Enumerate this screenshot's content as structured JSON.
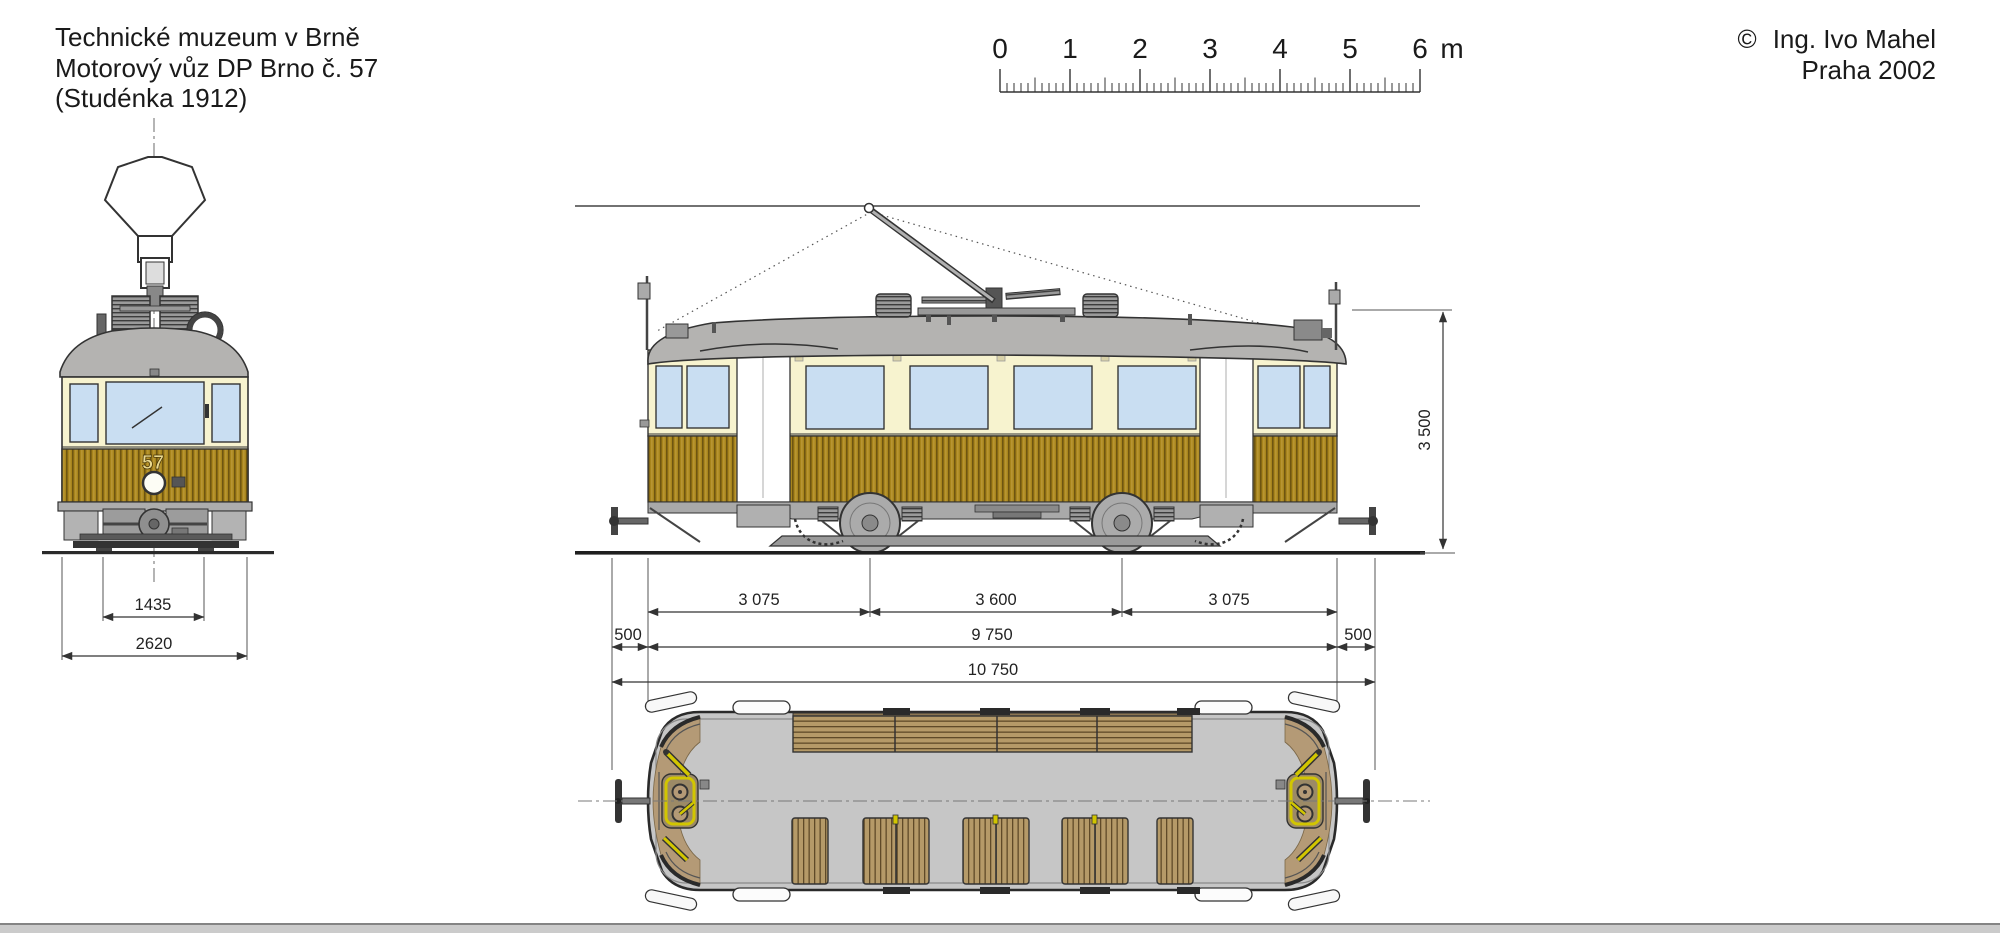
{
  "title_block": {
    "line1": "Technické muzeum v Brně",
    "line2": "Motorový vůz DP Brno č. 57",
    "line3": "(Studénka 1912)"
  },
  "credit": {
    "symbol": "©",
    "name": "Ing. Ivo Mahel",
    "city_year": "Praha 2002"
  },
  "scale_bar": {
    "tick_labels": [
      "0",
      "1",
      "2",
      "3",
      "4",
      "5",
      "6"
    ],
    "unit": "m",
    "minor_per_meter": 10
  },
  "vehicle": {
    "fleet_number": "57"
  },
  "dimensions": {
    "track_gauge_mm": "1435",
    "body_width_mm": "2620",
    "height_mm": "3 500",
    "front_overhang_mm": "3 075",
    "wheelbase_mm": "3 600",
    "rear_overhang_mm": "3 075",
    "coupling_left_mm": "500",
    "body_length_mm": "9 750",
    "coupling_right_mm": "500",
    "total_length_mm": "10 750"
  },
  "colors": {
    "body_cream": "#f7f3cf",
    "wood_panel": "#a8851c",
    "roof_gray": "#b4b3b1",
    "window_glass": "#c9def2",
    "floor_gray": "#c6c6c6",
    "platform_tan": "#b49a76",
    "control_yellow": "#d2c600",
    "line_ink": "#2a2a2a"
  }
}
